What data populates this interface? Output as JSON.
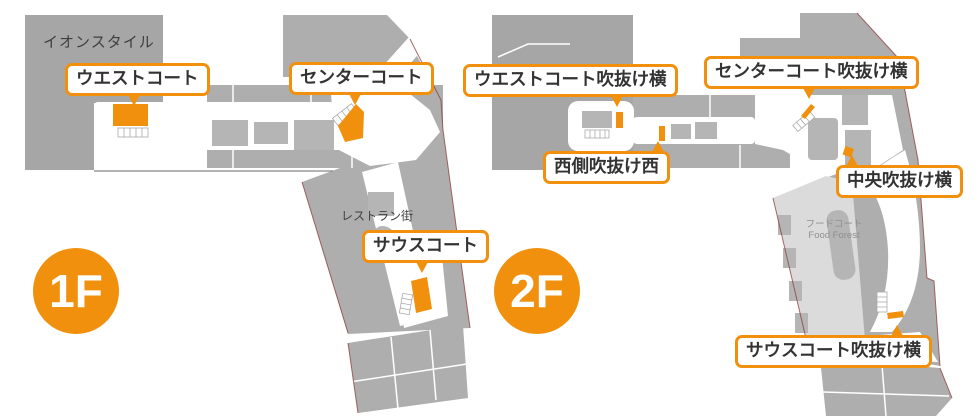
{
  "colors": {
    "accent": "#F0900D",
    "anchor_gray": "#a6a6a6",
    "store_gray": "#aeaeae",
    "island_gray": "#b5b5b5",
    "foodcourt_gray": "#dbdbdb",
    "outline_maroon": "#8a3a3a",
    "label_text": "#333333",
    "map_text": "#3f3f3f",
    "muted_text": "#8f8f8f"
  },
  "floor1": {
    "badge": "1F",
    "anchor_store": "イオンスタイル",
    "area_note": "レストラン街",
    "callouts": {
      "west": "ウエストコート",
      "center": "センターコート",
      "south": "サウスコート"
    }
  },
  "floor2": {
    "badge": "2F",
    "food_court_jp": "フードコート",
    "food_court_en": "Food Forest",
    "callouts": {
      "west_void": "ウエストコート吹抜け横",
      "center_void": "センターコート吹抜け横",
      "west_side": "西側吹抜け西",
      "central": "中央吹抜け横",
      "south_void": "サウスコート吹抜け横"
    }
  }
}
